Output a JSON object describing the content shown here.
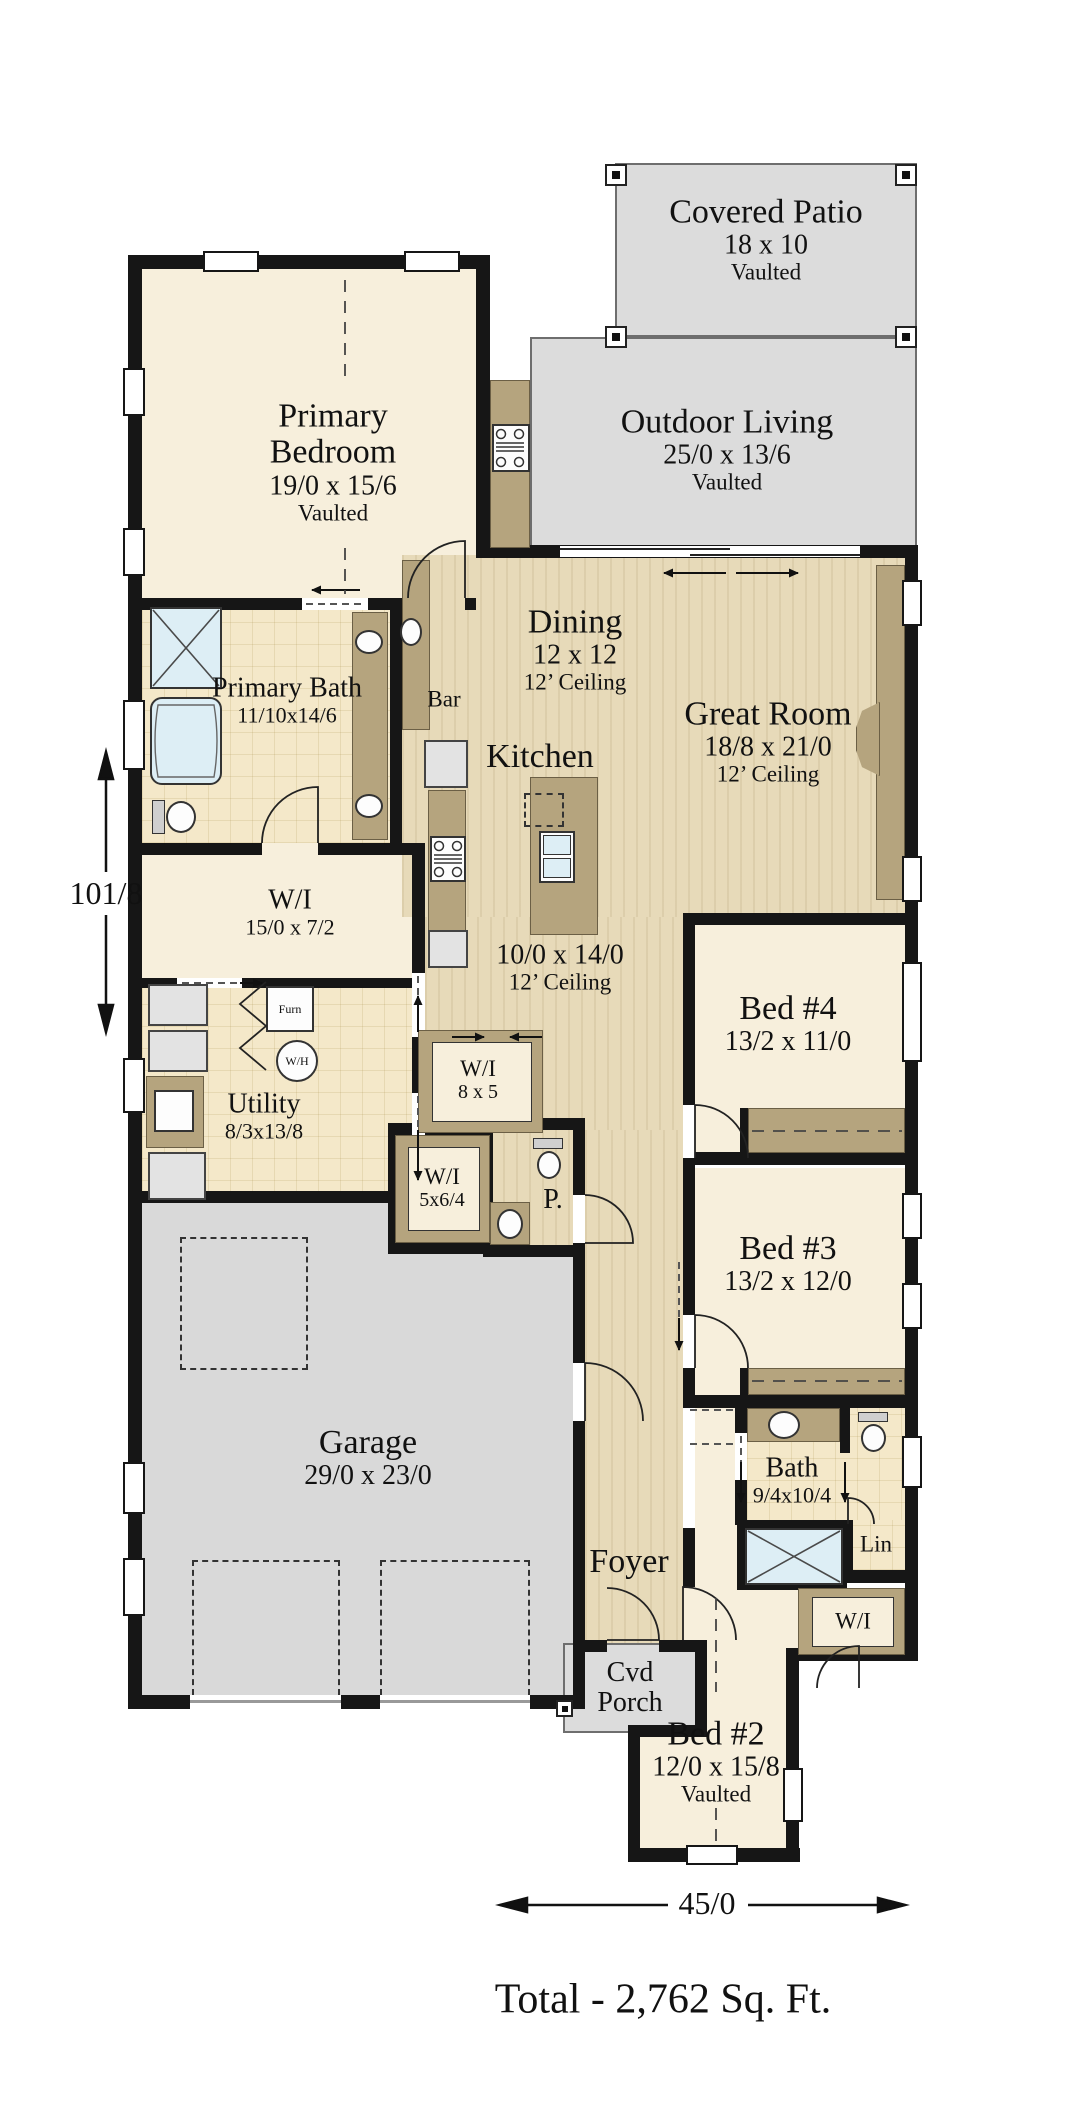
{
  "rooms": {
    "covered_patio": {
      "name": "Covered Patio",
      "size": "18 x 10",
      "note": "Vaulted"
    },
    "outdoor_living": {
      "name": "Outdoor Living",
      "size": "25/0 x 13/6",
      "note": "Vaulted"
    },
    "primary_bedroom": {
      "name": "Primary Bedroom",
      "size": "19/0 x 15/6",
      "note": "Vaulted"
    },
    "primary_bath": {
      "name": "Primary Bath",
      "size": "11/10x14/6"
    },
    "bar": {
      "name": "Bar"
    },
    "dining": {
      "name": "Dining",
      "size": "12 x 12",
      "note": "12’ Ceiling"
    },
    "great_room": {
      "name": "Great Room",
      "size": "18/8 x 21/0",
      "note": "12’ Ceiling"
    },
    "kitchen": {
      "name": "Kitchen",
      "size": "10/0 x 14/0",
      "note": "12’ Ceiling"
    },
    "wi_primary": {
      "name": "W/I",
      "size": "15/0 x 7/2"
    },
    "utility": {
      "name": "Utility",
      "size": "8/3x13/8"
    },
    "furnace": {
      "name": "Furn"
    },
    "water_heater": {
      "name": "W/H"
    },
    "wi_hall": {
      "name": "W/I",
      "size": "8 x 5"
    },
    "wi_small": {
      "name": "W/I",
      "size": "5x6/4"
    },
    "powder": {
      "name": "P."
    },
    "bed4": {
      "name": "Bed #4",
      "size": "13/2 x 11/0"
    },
    "bed3": {
      "name": "Bed #3",
      "size": "13/2 x 12/0"
    },
    "bath2": {
      "name": "Bath",
      "size": "9/4x10/4"
    },
    "linen": {
      "name": "Lin"
    },
    "wi_bed2": {
      "name": "W/I"
    },
    "garage": {
      "name": "Garage",
      "size": "29/0 x 23/0"
    },
    "foyer": {
      "name": "Foyer"
    },
    "cvd_porch": {
      "name": "Cvd Porch"
    },
    "bed2": {
      "name": "Bed #2",
      "size": "12/0 x 15/8",
      "note": "Vaulted"
    }
  },
  "dimensions": {
    "overall_depth": "101/8",
    "overall_width": "45/0"
  },
  "total_area": "Total - 2,762 Sq. Ft.",
  "palette": {
    "wall": "#161616",
    "wood_floor": "#e7dab9",
    "tile_floor": "#f4e8c9",
    "carpet_floor": "#f7efdc",
    "outdoor_gray": "#dcdcdc",
    "cabinet_tan": "#b5a47e",
    "fixture_blue": "#ddeef5"
  }
}
